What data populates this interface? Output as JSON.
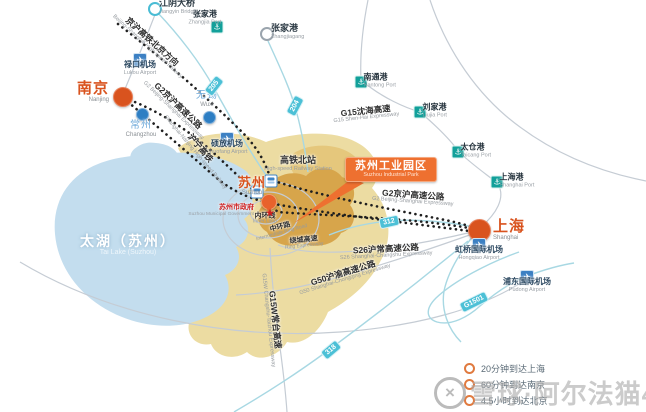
{
  "colors": {
    "accent_orange": "#d9531e",
    "callout_orange": "#ee7030",
    "minor_city_blue": "#2d7ec3",
    "minor_city_text": "#6ea9d9",
    "port_teal": "#12a09a",
    "airport_blue": "#3c80c3",
    "shield_teal": "#4cc0d6",
    "land_tan": "#ecdca2",
    "land_dark_tan": "#d7a54b",
    "lake_blue": "#c3ddee",
    "government_red": "#cf1f1f"
  },
  "icons": {
    "port": "⚓",
    "airport": "✈",
    "government_star": "★",
    "legend_ring": "○",
    "watermark_logo": "×"
  },
  "callout": {
    "label": "苏州工业园区",
    "en": "Suzhou Industrial Park"
  },
  "suzhou": {
    "name": "苏州",
    "en": "Suzhou",
    "gov_label": "苏州市政府",
    "gov_en": "Suzhou Municipal Government"
  },
  "lake": {
    "label": "太湖（苏州）",
    "en": "Tai Lake (Suzhou)"
  },
  "cities": [
    {
      "id": "nanjing",
      "name": "南京",
      "en": "Nanjing",
      "type": "major",
      "x": 122,
      "y": 96,
      "r": 18,
      "labelPos": "left"
    },
    {
      "id": "shanghai",
      "name": "上海",
      "en": "Shanghai",
      "type": "major",
      "x": 478,
      "y": 229,
      "r": 21,
      "labelPos": "right"
    },
    {
      "id": "wuxi",
      "name": "无锡",
      "en": "Wuxi",
      "type": "minor",
      "x": 208,
      "y": 116,
      "r": 11,
      "labelPos": "above"
    },
    {
      "id": "changzhou",
      "name": "常州",
      "en": "Changzhou",
      "type": "minor",
      "x": 141,
      "y": 113,
      "r": 11,
      "labelPos": "below"
    }
  ],
  "ports": [
    {
      "name": "张家港",
      "en": "Zhangjia Port",
      "x": 217,
      "y": 27,
      "labelPos": "above"
    },
    {
      "name": "南通港",
      "en": "Nantong Port",
      "x": 361,
      "y": 82,
      "labelPos": "right"
    },
    {
      "name": "刘家港",
      "en": "Liujia Port",
      "x": 420,
      "y": 112,
      "labelPos": "right"
    },
    {
      "name": "太仓港",
      "en": "Taicang Port",
      "x": 458,
      "y": 152,
      "labelPos": "right"
    },
    {
      "name": "上海港",
      "en": "Shanghai Port",
      "x": 497,
      "y": 182,
      "labelPos": "right"
    }
  ],
  "airports": [
    {
      "name": "禄口机场",
      "en": "Lukou Airport",
      "x": 140,
      "y": 60
    },
    {
      "name": "硕放机场",
      "en": "Shuofang Airport",
      "x": 227,
      "y": 139
    },
    {
      "name": "虹桥国际机场",
      "en": "Hongqiao Airport",
      "x": 479,
      "y": 245
    },
    {
      "name": "浦东国际机场",
      "en": "Pudong Airport",
      "x": 527,
      "y": 277
    }
  ],
  "landmarks": [
    {
      "name": "江阴大桥",
      "en": "Jiangyin Bridge",
      "x": 155,
      "y": 9,
      "ring": "teal"
    },
    {
      "name": "张家港",
      "en": "Zhangjiagang",
      "x": 267,
      "y": 34,
      "ring": "gray"
    }
  ],
  "station": {
    "label": "高铁北站",
    "en": "High-speed Railway Station",
    "label_x": 298,
    "label_y": 164,
    "icons": [
      {
        "x": 271,
        "y": 181
      },
      {
        "x": 257,
        "y": 192
      }
    ]
  },
  "road_labels": [
    {
      "name": "京沪高铁北京方向",
      "en": "Beijing-Shanghai High-speed Railway",
      "x": 150,
      "y": 44,
      "rot": 42,
      "size": "m"
    },
    {
      "name": "G2京沪高速公路",
      "en": "G2 Beijing-Shanghai Expressway",
      "x": 176,
      "y": 108,
      "rot": 44,
      "size": "m"
    },
    {
      "name": "沪宁高铁",
      "en": "Shanghai-Nanjing High-speed Railway",
      "x": 198,
      "y": 150,
      "rot": 50,
      "size": "m"
    },
    {
      "name": "G15沈海高速",
      "en": "G15 Shen-Hai Expressway",
      "x": 366,
      "y": 114,
      "rot": -6,
      "size": "m"
    },
    {
      "name": "G2京沪高速公路",
      "en": "G2 Beijing-Shanghai Expressway",
      "x": 413,
      "y": 198,
      "rot": 4,
      "size": "m"
    },
    {
      "name": "S26沪常高速公路",
      "en": "S26 Shanghai-Changshu Expressway",
      "x": 386,
      "y": 252,
      "rot": -3,
      "size": "m"
    },
    {
      "name": "G50沪渝高速公路",
      "en": "G50 Shanghai-Chongqing Expressway",
      "x": 344,
      "y": 276,
      "rot": -17,
      "size": "m"
    },
    {
      "name": "G15W常台高速",
      "en": "G15W Changshu-Taizhou Expressway",
      "x": 272,
      "y": 320,
      "rot": 84,
      "size": "m"
    },
    {
      "name": "绕城高速",
      "en": "Ring Expressway",
      "x": 304,
      "y": 243,
      "rot": -6,
      "size": "sm"
    },
    {
      "name": "中环路",
      "en": "Intermediate Ring Road",
      "x": 281,
      "y": 230,
      "rot": -15,
      "size": "sm"
    },
    {
      "name": "内环线",
      "en": "Inner Loop",
      "x": 265,
      "y": 219,
      "rot": 0,
      "size": "sm"
    }
  ],
  "shields": [
    {
      "label": "205",
      "x": 214,
      "y": 86,
      "rot": -52
    },
    {
      "label": "204",
      "x": 295,
      "y": 106,
      "rot": -62
    },
    {
      "label": "312",
      "x": 389,
      "y": 222,
      "rot": -12
    },
    {
      "label": "318",
      "x": 331,
      "y": 350,
      "rot": -40
    },
    {
      "label": "G1501",
      "x": 474,
      "y": 302,
      "rot": -26
    }
  ],
  "legend": {
    "items": [
      {
        "label": "20分钟到达上海"
      },
      {
        "label": "60分钟到达南京"
      },
      {
        "label": "4.5小时到达北京"
      }
    ]
  },
  "watermark": {
    "text": "雪球·阿尔法猫422"
  }
}
